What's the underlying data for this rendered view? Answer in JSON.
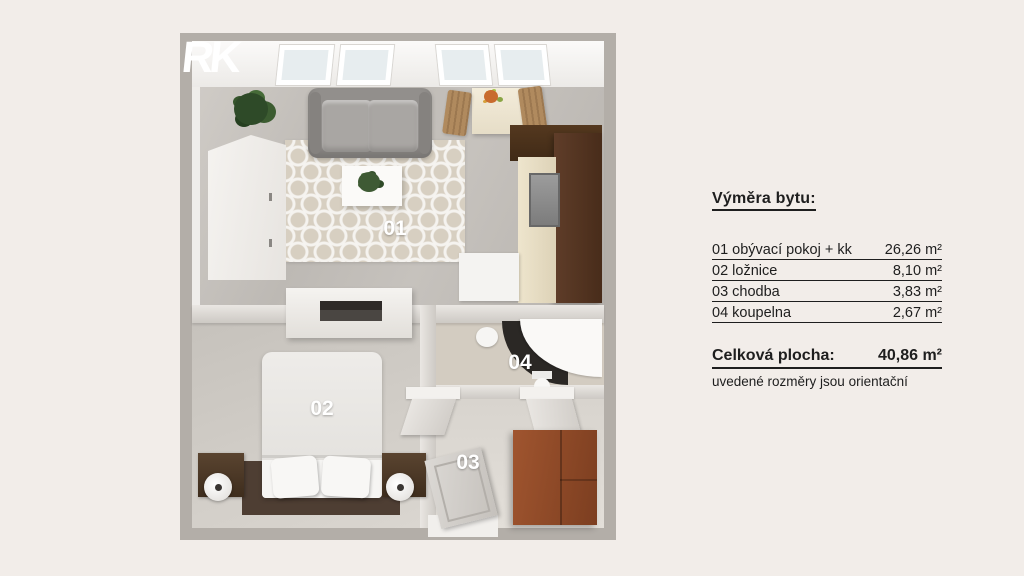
{
  "logo": {
    "text": "RK"
  },
  "floorplan": {
    "rooms": [
      "01",
      "02",
      "03",
      "04"
    ]
  },
  "legend": {
    "title": "Výměra bytu:",
    "rows": [
      {
        "label": "01 obývací pokoj + kk",
        "value": "26,26 m²"
      },
      {
        "label": "02 ložnice",
        "value": "8,10 m²"
      },
      {
        "label": "03 chodba",
        "value": "3,83 m²"
      },
      {
        "label": "04 koupelna",
        "value": "2,67 m²"
      }
    ],
    "total_label": "Celková plocha:",
    "total_value": "40,86 m²",
    "note": "uvedené rozměry jsou orientační"
  },
  "colors": {
    "background": "#F2EDE9",
    "wall": "#B3AEA8",
    "text": "#1E1E1E",
    "kitchen_wood": "#5A3826",
    "hall_wardrobe_wood": "#95502D",
    "label_text": "#FFFFFF"
  }
}
